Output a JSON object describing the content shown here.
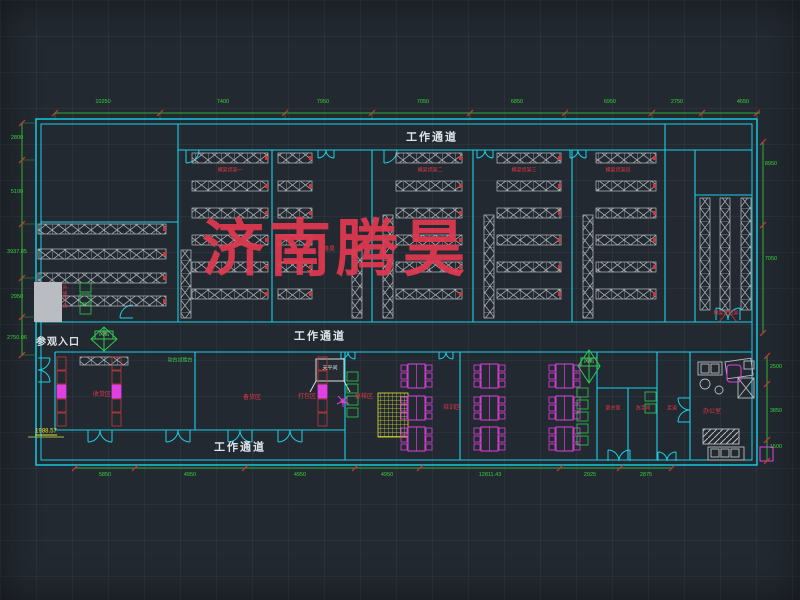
{
  "watermark": {
    "text": "济南腾昊",
    "small": "腾昊",
    "color": "#e13950"
  },
  "corridors": {
    "top": "工作通道",
    "middle": "工作通道",
    "bottom": "工作通道"
  },
  "entrance": "参观入口",
  "fan_label": "风机",
  "dimensions": {
    "top": [
      "10250",
      "7400",
      "7950",
      "7050",
      "6850",
      "6950",
      "2750",
      "4550"
    ],
    "left": [
      "2800",
      "5100",
      "3937.85",
      "2950",
      "2750.06"
    ],
    "right_upper": [
      "8950",
      "7050"
    ],
    "right_lower": [
      "2500",
      "3850",
      "1500"
    ],
    "bottom": [
      "5850",
      "4950",
      "4950",
      "4950",
      "12811.43",
      "2925",
      "2875"
    ],
    "datum": "1988.57"
  },
  "rack_labels": [
    "横梁货架一",
    "横梁货架二",
    "横梁货架三",
    "横梁货架四"
  ],
  "right_rack_label": "横梁式货架",
  "rooms": {
    "left1": "收货区",
    "left2": "备货区",
    "mid1": "打包区",
    "mid2": "复核区",
    "training": "培训区",
    "locker": "更衣室",
    "wash": "洗手间",
    "aisle": "走道",
    "office": "办公室",
    "platform": "升降平台",
    "test_bench": "动台试验台",
    "equip_box": "天平间"
  },
  "colors": {
    "background": "#232931",
    "wall": "#17d1e8",
    "dimension": "#35d435",
    "tick": "#d03838",
    "label_red": "#e03846",
    "magenta": "#e040e0",
    "yellow": "#e6e635",
    "rack": "#b9bdc1",
    "text": "#dfe4e8",
    "watermark": "#e13950"
  }
}
